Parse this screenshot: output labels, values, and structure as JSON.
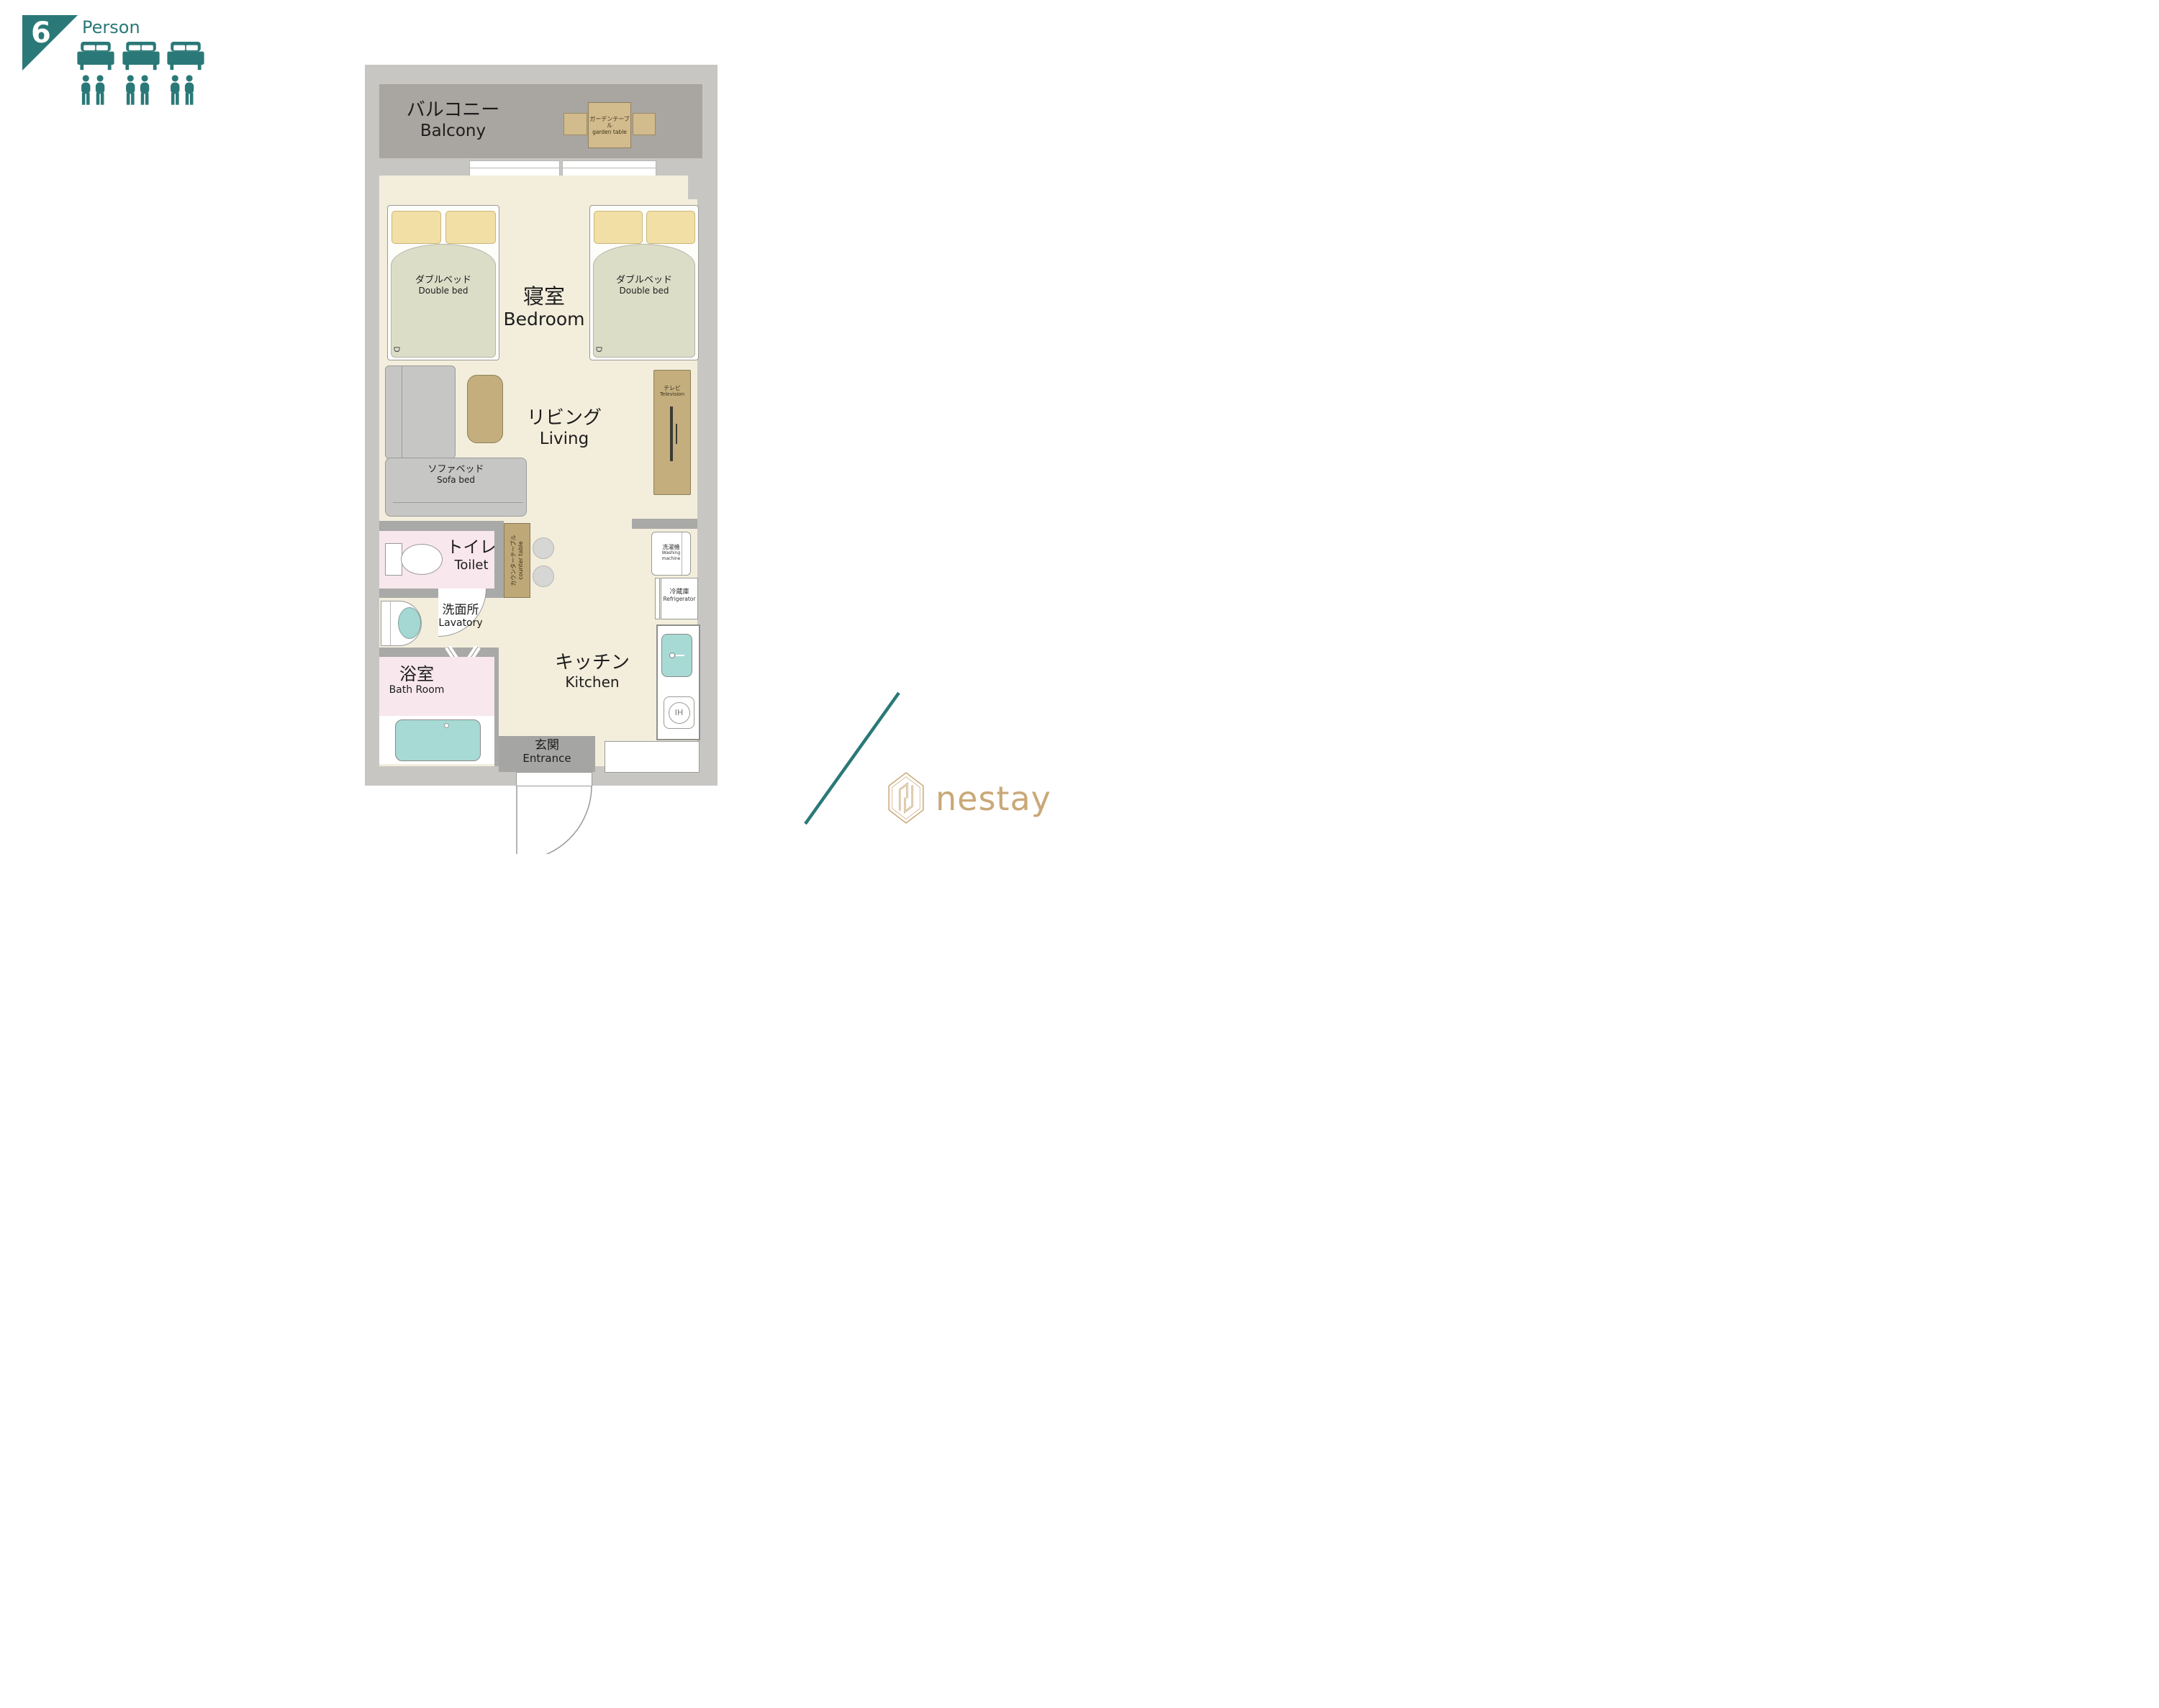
{
  "occupancy": {
    "count": "6",
    "label": "Person"
  },
  "colors": {
    "accent_teal": "#2A7978",
    "brand_gold": "#C9A878",
    "floor_cream": "#F3EEDC",
    "wall_grey": "#C8C6C3",
    "room_pink": "#F8E7ED",
    "fixture_teal": "#A7DAD4"
  },
  "plan": {
    "balcony": {
      "jp": "バルコニー",
      "en": "Balcony"
    },
    "garden_table": {
      "jp": "ガーデンテーブル",
      "en": "garden table"
    },
    "bedroom": {
      "jp": "寝室",
      "en": "Bedroom"
    },
    "double_bed": {
      "jp": "ダブルベッド",
      "en": "Double bed"
    },
    "bed_mark": "D",
    "living": {
      "jp": "リビング",
      "en": "Living"
    },
    "sofa_bed": {
      "jp": "ソファベッド",
      "en": "Sofa bed"
    },
    "television": {
      "jp": "テレビ",
      "en": "Television"
    },
    "toilet": {
      "jp": "トイレ",
      "en": "Toilet"
    },
    "counter_table": {
      "jp": "カウンターテーブル",
      "en": "counter table"
    },
    "lavatory": {
      "jp": "洗面所",
      "en": "Lavatory"
    },
    "bath": {
      "jp": "浴室",
      "en": "Bath Room"
    },
    "kitchen": {
      "jp": "キッチン",
      "en": "Kitchen"
    },
    "entrance": {
      "jp": "玄関",
      "en": "Entrance"
    },
    "washing_machine": {
      "jp": "洗濯機",
      "en": "Washing machine"
    },
    "refrigerator": {
      "jp": "冷蔵庫",
      "en": "Refrigerator"
    },
    "ih_stove": "IH"
  },
  "brand": {
    "name": "nestay"
  }
}
